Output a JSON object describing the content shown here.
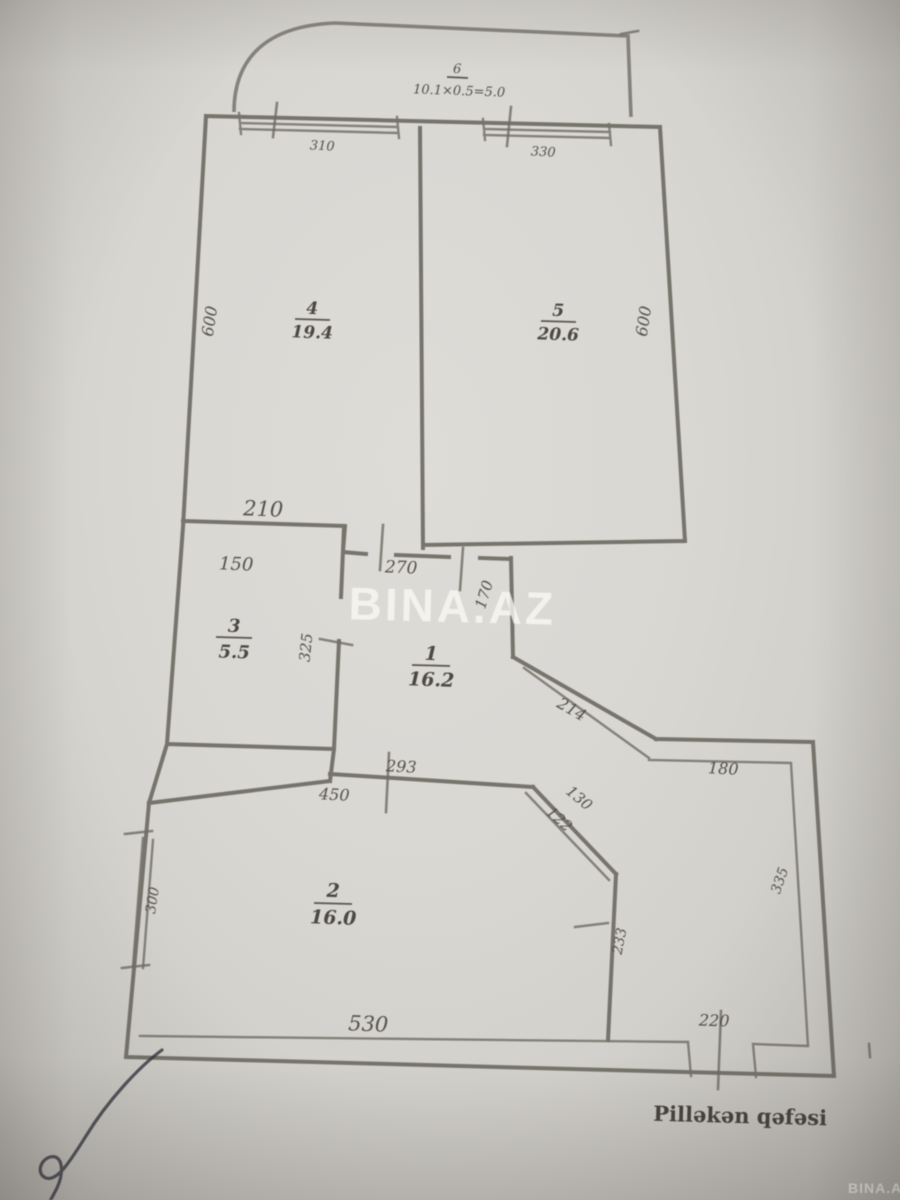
{
  "watermark": {
    "center": "BINA.AZ",
    "corner": "BINA.AZ"
  },
  "caption": {
    "stairwell": "Pilləkən qəfəsi"
  },
  "balcony": {
    "number": "6",
    "formula": "10.1×0.5=5.0"
  },
  "rooms": [
    {
      "number": "1",
      "area": "16.2"
    },
    {
      "number": "2",
      "area": "16.0"
    },
    {
      "number": "3",
      "area": "5.5"
    },
    {
      "number": "4",
      "area": "19.4"
    },
    {
      "number": "5",
      "area": "20.6"
    }
  ],
  "dimensions": {
    "window_left": "310",
    "window_right": "330",
    "side_left": "600",
    "side_right": "600",
    "room3_top": "210",
    "room3_width": "150",
    "room3_height": "325",
    "hall_top": "270",
    "hall_right": "170",
    "diagonal_upper": "214",
    "ledge": "180",
    "hall_bottom": "293",
    "room2_top": "450",
    "diag_lower_a": "130",
    "diag_lower_b": "122",
    "room2_left": "300",
    "room2_right": "233",
    "right_lower": "335",
    "room2_bottom": "530",
    "stair_door": "220"
  }
}
